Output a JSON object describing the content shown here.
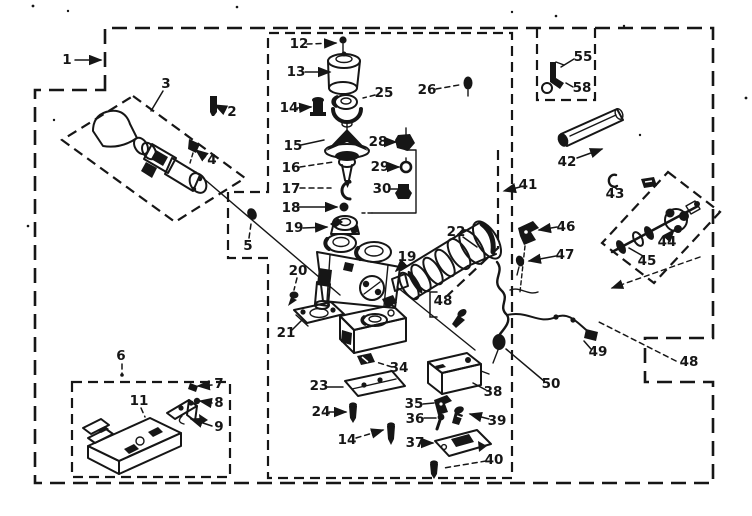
{
  "figure": {
    "kind": "exploded-parts-diagram",
    "ink": "#161616",
    "paper": "#ffffff"
  },
  "callouts": [
    {
      "label": "1",
      "x": 67,
      "y": 60,
      "leader": [
        [
          75,
          60
        ],
        [
          101,
          60
        ]
      ],
      "dashed": false,
      "arrow": true
    },
    {
      "label": "2",
      "x": 232,
      "y": 112,
      "leader": [
        [
          225,
          110
        ],
        [
          215,
          105
        ]
      ],
      "dashed": false,
      "arrow": true
    },
    {
      "label": "3",
      "x": 166,
      "y": 84,
      "leader": [
        [
          163,
          91
        ],
        [
          151,
          111
        ]
      ],
      "dashed": false,
      "arrow": false
    },
    {
      "label": "4",
      "x": 212,
      "y": 160,
      "leader": [
        [
          205,
          157
        ],
        [
          196,
          150
        ]
      ],
      "dashed": false,
      "arrow": true
    },
    {
      "label": "5",
      "x": 248,
      "y": 246,
      "leader": [
        [
          249,
          238
        ],
        [
          251,
          224
        ]
      ],
      "dashed": true,
      "arrow": false
    },
    {
      "label": "6",
      "x": 121,
      "y": 356,
      "leader": [
        [
          122,
          364
        ],
        [
          122,
          374
        ]
      ],
      "dashed": true,
      "arrow": false
    },
    {
      "label": "7",
      "x": 219,
      "y": 384,
      "leader": [
        [
          212,
          385
        ],
        [
          198,
          386
        ]
      ],
      "dashed": false,
      "arrow": true
    },
    {
      "label": "8",
      "x": 219,
      "y": 403,
      "leader": [
        [
          212,
          403
        ],
        [
          200,
          401
        ]
      ],
      "dashed": false,
      "arrow": true
    },
    {
      "label": "9",
      "x": 219,
      "y": 427,
      "leader": [
        [
          212,
          426
        ],
        [
          191,
          419
        ]
      ],
      "dashed": false,
      "arrow": true
    },
    {
      "label": "11",
      "x": 139,
      "y": 401,
      "leader": [
        [
          141,
          408
        ],
        [
          145,
          417
        ]
      ],
      "dashed": true,
      "arrow": false
    },
    {
      "label": "12",
      "x": 299,
      "y": 44,
      "leader": [
        [
          307,
          44
        ],
        [
          336,
          43
        ]
      ],
      "dashed": true,
      "arrow": true
    },
    {
      "label": "13",
      "x": 296,
      "y": 72,
      "leader": [
        [
          305,
          72
        ],
        [
          330,
          72
        ]
      ],
      "dashed": false,
      "arrow": true
    },
    {
      "label": "14",
      "x": 289,
      "y": 108,
      "leader": [
        [
          297,
          108
        ],
        [
          311,
          107
        ]
      ],
      "dashed": false,
      "arrow": true
    },
    {
      "label": "15",
      "x": 293,
      "y": 146,
      "leader": [
        [
          301,
          145
        ],
        [
          324,
          140
        ]
      ],
      "dashed": false,
      "arrow": false
    },
    {
      "label": "16",
      "x": 291,
      "y": 168,
      "leader": [
        [
          300,
          167
        ],
        [
          333,
          162
        ]
      ],
      "dashed": true,
      "arrow": false
    },
    {
      "label": "17",
      "x": 291,
      "y": 189,
      "leader": [
        [
          300,
          188
        ],
        [
          331,
          188
        ]
      ],
      "dashed": true,
      "arrow": false
    },
    {
      "label": "18",
      "x": 291,
      "y": 208,
      "leader": [
        [
          299,
          207
        ],
        [
          337,
          207
        ]
      ],
      "dashed": false,
      "arrow": true
    },
    {
      "label": "19",
      "x": 294,
      "y": 228,
      "leader": [
        [
          303,
          228
        ],
        [
          327,
          227
        ]
      ],
      "dashed": false,
      "arrow": true
    },
    {
      "label": "20",
      "x": 298,
      "y": 271,
      "leader": [
        [
          297,
          278
        ],
        [
          294,
          290
        ]
      ],
      "dashed": true,
      "arrow": false
    },
    {
      "label": "21",
      "x": 286,
      "y": 333,
      "leader": [
        [
          292,
          330
        ],
        [
          303,
          319
        ]
      ],
      "dashed": false,
      "arrow": false
    },
    {
      "label": "22",
      "x": 456,
      "y": 232,
      "leader": [
        [
          463,
          237
        ],
        [
          477,
          247
        ]
      ],
      "dashed": false,
      "arrow": false
    },
    {
      "label": "23",
      "x": 319,
      "y": 386,
      "leader": [
        [
          327,
          387
        ],
        [
          343,
          387
        ]
      ],
      "dashed": false,
      "arrow": false
    },
    {
      "label": "24",
      "x": 321,
      "y": 412,
      "leader": [
        [
          329,
          412
        ],
        [
          346,
          412
        ]
      ],
      "dashed": false,
      "arrow": true
    },
    {
      "label": "25",
      "x": 384,
      "y": 93,
      "leader": [
        [
          375,
          95
        ],
        [
          363,
          98
        ]
      ],
      "dashed": true,
      "arrow": false
    },
    {
      "label": "26",
      "x": 427,
      "y": 90,
      "leader": [
        [
          436,
          89
        ],
        [
          459,
          85
        ]
      ],
      "dashed": true,
      "arrow": false
    },
    {
      "label": "28",
      "x": 378,
      "y": 142,
      "leader": [
        [
          387,
          142
        ],
        [
          396,
          142
        ]
      ],
      "dashed": false,
      "arrow": true
    },
    {
      "label": "29",
      "x": 380,
      "y": 167,
      "leader": [
        [
          389,
          167
        ],
        [
          399,
          167
        ]
      ],
      "dashed": false,
      "arrow": true
    },
    {
      "label": "30",
      "x": 382,
      "y": 189,
      "leader": [
        [
          391,
          189
        ],
        [
          398,
          189
        ]
      ],
      "dashed": false,
      "arrow": false
    },
    {
      "label": "34",
      "x": 399,
      "y": 368,
      "leader": [
        [
          392,
          367
        ],
        [
          376,
          362
        ]
      ],
      "dashed": true,
      "arrow": false
    },
    {
      "label": "35",
      "x": 414,
      "y": 404,
      "leader": [
        [
          423,
          404
        ],
        [
          434,
          403
        ]
      ],
      "dashed": false,
      "arrow": false
    },
    {
      "label": "36",
      "x": 415,
      "y": 419,
      "leader": [
        [
          424,
          418
        ],
        [
          436,
          418
        ]
      ],
      "dashed": false,
      "arrow": false
    },
    {
      "label": "37",
      "x": 415,
      "y": 443,
      "leader": [
        [
          424,
          443
        ],
        [
          433,
          443
        ]
      ],
      "dashed": false,
      "arrow": true
    },
    {
      "label": "38",
      "x": 493,
      "y": 392,
      "leader": [
        [
          486,
          390
        ],
        [
          473,
          383
        ]
      ],
      "dashed": false,
      "arrow": false
    },
    {
      "label": "39",
      "x": 497,
      "y": 421,
      "leader": [
        [
          489,
          419
        ],
        [
          470,
          414
        ]
      ],
      "dashed": false,
      "arrow": true
    },
    {
      "label": "40",
      "x": 494,
      "y": 460,
      "leader": [
        [
          486,
          461
        ],
        [
          444,
          468
        ]
      ],
      "dashed": true,
      "arrow": false
    },
    {
      "label": "41",
      "x": 528,
      "y": 185,
      "leader": [
        [
          520,
          187
        ],
        [
          504,
          191
        ]
      ],
      "dashed": true,
      "arrow": true
    },
    {
      "label": "42",
      "x": 567,
      "y": 162,
      "leader": [
        [
          577,
          158
        ],
        [
          602,
          149
        ]
      ],
      "dashed": false,
      "arrow": true
    },
    {
      "label": "43",
      "x": 615,
      "y": 194,
      "leader": [
        [
          617,
          189
        ],
        [
          613,
          186
        ]
      ],
      "dashed": false,
      "arrow": false
    },
    {
      "label": "44",
      "x": 667,
      "y": 242,
      "leader": [
        [
          668,
          237
        ],
        [
          674,
          230
        ]
      ],
      "dashed": false,
      "arrow": true
    },
    {
      "label": "45",
      "x": 647,
      "y": 261,
      "leader": [
        [
          643,
          256
        ],
        [
          629,
          248
        ]
      ],
      "dashed": false,
      "arrow": false
    },
    {
      "label": "46",
      "x": 566,
      "y": 227,
      "leader": [
        [
          557,
          227
        ],
        [
          539,
          230
        ]
      ],
      "dashed": false,
      "arrow": true
    },
    {
      "label": "47",
      "x": 565,
      "y": 255,
      "leader": [
        [
          556,
          256
        ],
        [
          529,
          261
        ]
      ],
      "dashed": false,
      "arrow": true
    },
    {
      "label": "48",
      "x": 443,
      "y": 301,
      "leader": [
        [
          437,
          292
        ],
        [
          430,
          292
        ],
        [
          430,
          317
        ],
        [
          437,
          317
        ]
      ],
      "dashed": false,
      "arrow": false
    },
    {
      "label": "48",
      "x": 689,
      "y": 362,
      "leader": [
        [
          676,
          361
        ],
        [
          597,
          321
        ]
      ],
      "dashed": true,
      "arrow": false
    },
    {
      "label": "49",
      "x": 598,
      "y": 352,
      "leader": [
        [
          591,
          349
        ],
        [
          584,
          341
        ]
      ],
      "dashed": false,
      "arrow": false
    },
    {
      "label": "50",
      "x": 551,
      "y": 384,
      "leader": [
        [
          544,
          381
        ],
        [
          506,
          349
        ]
      ],
      "dashed": false,
      "arrow": false
    },
    {
      "label": "55",
      "x": 583,
      "y": 57,
      "leader": [
        [
          574,
          59
        ],
        [
          561,
          67
        ]
      ],
      "dashed": false,
      "arrow": false
    },
    {
      "label": "58",
      "x": 582,
      "y": 88,
      "leader": [
        [
          573,
          87
        ],
        [
          566,
          83
        ]
      ],
      "dashed": false,
      "arrow": false
    },
    {
      "label": "14",
      "x": 347,
      "y": 440,
      "leader": [
        [
          356,
          438
        ],
        [
          383,
          430
        ]
      ],
      "dashed": true,
      "arrow": true
    },
    {
      "label": "19",
      "x": 407,
      "y": 257,
      "leader": [
        [
          404,
          263
        ],
        [
          396,
          271
        ]
      ],
      "dashed": false,
      "arrow": true
    }
  ]
}
